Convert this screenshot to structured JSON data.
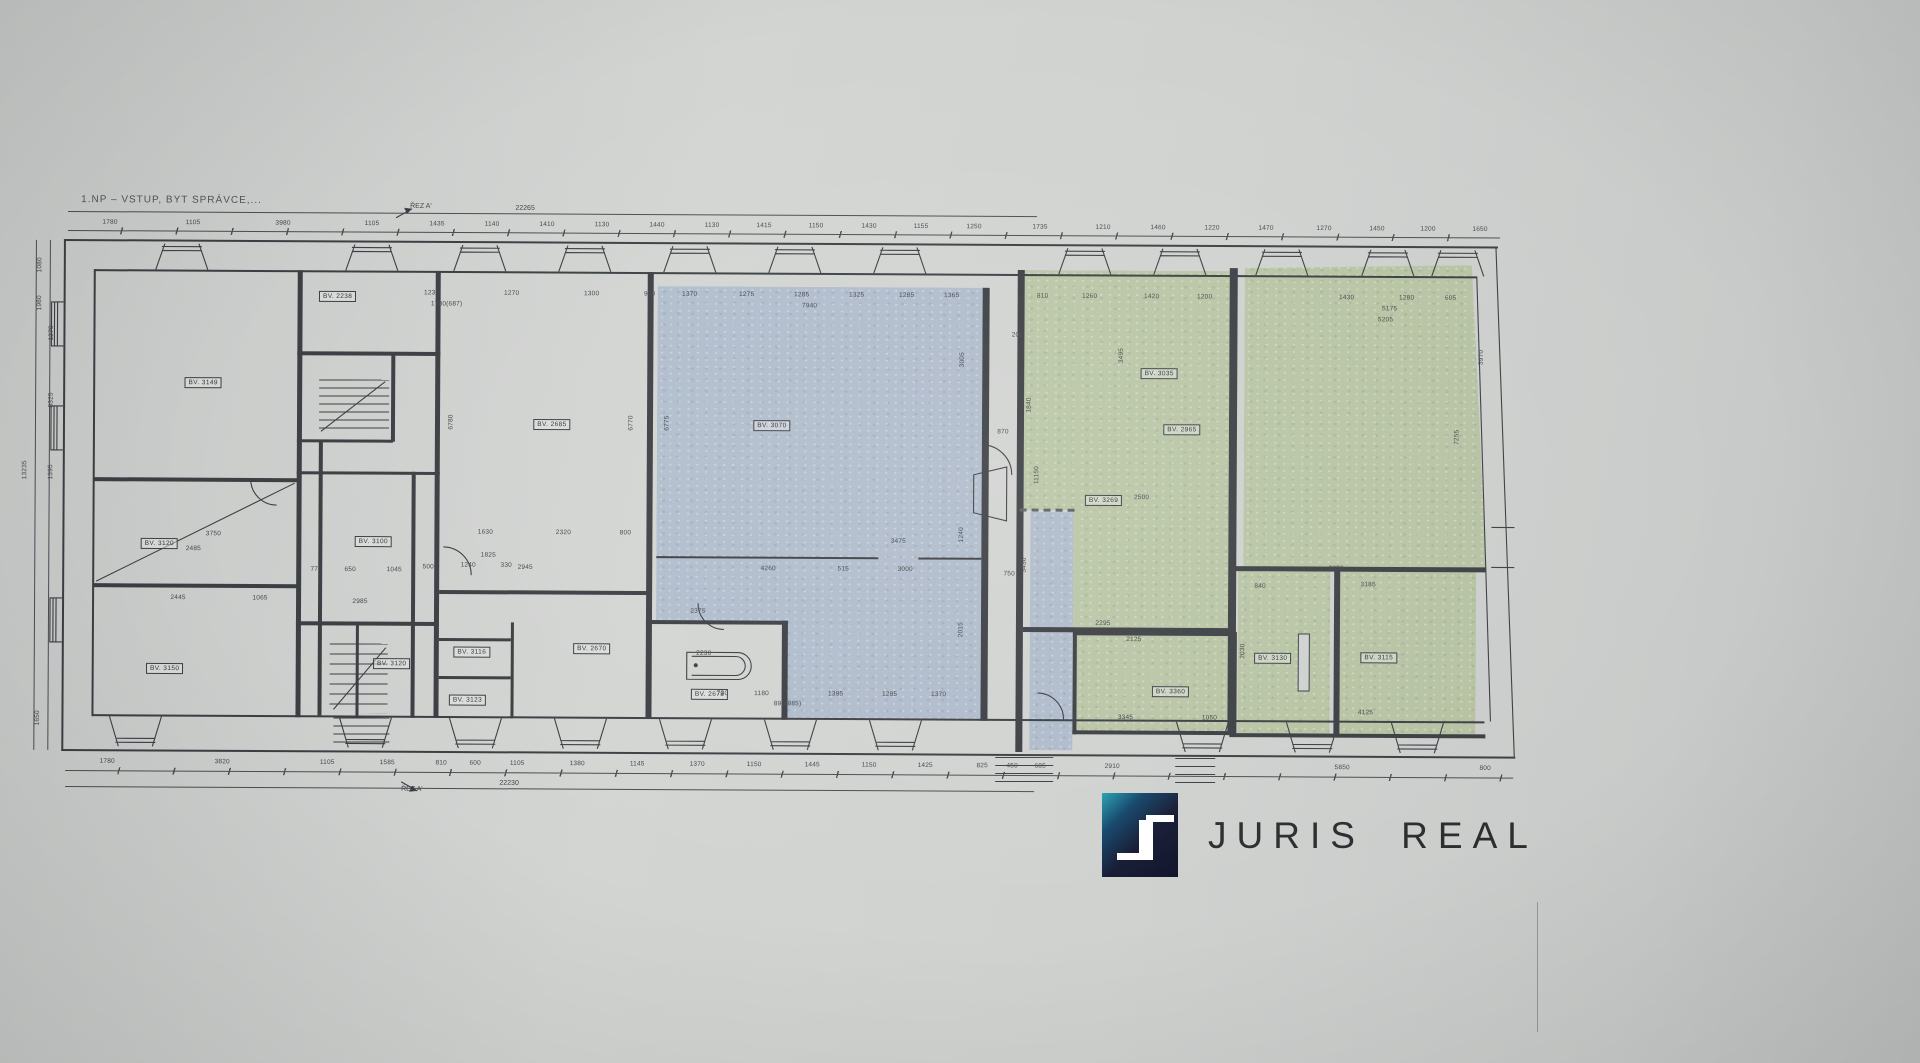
{
  "title": "1.NP – VSTUP, BYT SPRÁVCE,...",
  "section_mark_top": "ŘEZ A'",
  "section_mark_bottom": "ŘEZ A'",
  "overall_dim_top": "22265",
  "overall_dim_bottom": "22230",
  "logo": {
    "brand": "JURIS REAL"
  },
  "colors": {
    "paper": "#cfd1d0",
    "line": "#3b3e42",
    "dim_text": "#45484d",
    "blue_tint": "#b9c7da",
    "green_tint": "#c2cfa9",
    "logo_navy": "#161b34",
    "logo_teal": "#26a2b0",
    "logo_text": "#2c2d2f"
  },
  "rooms": [
    {
      "label": "BV. 3149",
      "x": 204,
      "y": 382
    },
    {
      "label": "BV. 2238",
      "x": 338,
      "y": 295
    },
    {
      "label": "BV. 3120",
      "x": 161,
      "y": 543
    },
    {
      "label": "BV. 3150",
      "x": 167,
      "y": 668
    },
    {
      "label": "BV. 2685",
      "x": 553,
      "y": 422
    },
    {
      "label": "BV. 3100",
      "x": 375,
      "y": 540
    },
    {
      "label": "BV. 3070",
      "x": 773,
      "y": 422
    },
    {
      "label": "BV. 2670",
      "x": 594,
      "y": 646
    },
    {
      "label": "BV. 2678",
      "x": 712,
      "y": 691
    },
    {
      "label": "BV. 3120",
      "x": 394,
      "y": 662
    },
    {
      "label": "BV. 3116",
      "x": 474,
      "y": 650
    },
    {
      "label": "BV. 3123",
      "x": 470,
      "y": 698
    },
    {
      "label": "BV. 3035",
      "x": 1160,
      "y": 368
    },
    {
      "label": "BV. 2965",
      "x": 1183,
      "y": 424
    },
    {
      "label": "BV. 3269",
      "x": 1105,
      "y": 495
    },
    {
      "label": "BV. 3360",
      "x": 1173,
      "y": 686
    },
    {
      "label": "BV. 3130",
      "x": 1275,
      "y": 652
    },
    {
      "label": "BV. 3115",
      "x": 1381,
      "y": 651
    }
  ],
  "dims_top": [
    {
      "t": "1780",
      "x": 110
    },
    {
      "t": "1105",
      "x": 193
    },
    {
      "t": "3980",
      "x": 283
    },
    {
      "t": "1105",
      "x": 372
    },
    {
      "t": "1435",
      "x": 437
    },
    {
      "t": "1140",
      "x": 492
    },
    {
      "t": "1410",
      "x": 547
    },
    {
      "t": "1130",
      "x": 602
    },
    {
      "t": "1440",
      "x": 657
    },
    {
      "t": "1130",
      "x": 712
    },
    {
      "t": "1415",
      "x": 764
    },
    {
      "t": "1150",
      "x": 816
    },
    {
      "t": "1430",
      "x": 869
    },
    {
      "t": "1155",
      "x": 921
    },
    {
      "t": "1250",
      "x": 974
    },
    {
      "t": "1735",
      "x": 1040
    },
    {
      "t": "1210",
      "x": 1103
    },
    {
      "t": "1460",
      "x": 1158
    },
    {
      "t": "1220",
      "x": 1212
    },
    {
      "t": "1470",
      "x": 1266
    },
    {
      "t": "1270",
      "x": 1324
    },
    {
      "t": "1450",
      "x": 1377
    },
    {
      "t": "1200",
      "x": 1428
    },
    {
      "t": "1650",
      "x": 1480
    }
  ],
  "dims_bottom": [
    {
      "t": "1780",
      "x": 110
    },
    {
      "t": "3820",
      "x": 225
    },
    {
      "t": "1105",
      "x": 330
    },
    {
      "t": "1585",
      "x": 390
    },
    {
      "t": "810",
      "x": 444
    },
    {
      "t": "600",
      "x": 478
    },
    {
      "t": "1105",
      "x": 520
    },
    {
      "t": "1380",
      "x": 580
    },
    {
      "t": "1145",
      "x": 640
    },
    {
      "t": "1370",
      "x": 700
    },
    {
      "t": "1150",
      "x": 757
    },
    {
      "t": "1445",
      "x": 815
    },
    {
      "t": "1150",
      "x": 872
    },
    {
      "t": "1425",
      "x": 928
    },
    {
      "t": "825",
      "x": 985
    },
    {
      "t": "450",
      "x": 1015
    },
    {
      "t": "685",
      "x": 1043
    },
    {
      "t": "2910",
      "x": 1115
    },
    {
      "t": "5850",
      "x": 1345
    },
    {
      "t": "800",
      "x": 1488
    }
  ],
  "dims_side": [
    {
      "t": "13235",
      "x": 26,
      "y": 470,
      "r": 1
    },
    {
      "t": "1080",
      "x": 40,
      "y": 265,
      "r": 1
    },
    {
      "t": "1980",
      "x": 40,
      "y": 303,
      "r": 1
    },
    {
      "t": "1270",
      "x": 52,
      "y": 333,
      "r": 1
    },
    {
      "t": "5325",
      "x": 52,
      "y": 400,
      "r": 1
    },
    {
      "t": "1395",
      "x": 52,
      "y": 472,
      "r": 1
    },
    {
      "t": "1650",
      "x": 40,
      "y": 718,
      "r": 1
    }
  ],
  "dims_inner": [
    {
      "t": "1230",
      "x": 432,
      "y": 291
    },
    {
      "t": "1270",
      "x": 512,
      "y": 291
    },
    {
      "t": "1300",
      "x": 592,
      "y": 291
    },
    {
      "t": "950",
      "x": 650,
      "y": 291
    },
    {
      "t": "1780(687)",
      "x": 447,
      "y": 302
    },
    {
      "t": "1370",
      "x": 690,
      "y": 291
    },
    {
      "t": "1275",
      "x": 747,
      "y": 291
    },
    {
      "t": "1285",
      "x": 802,
      "y": 291
    },
    {
      "t": "1325",
      "x": 857,
      "y": 291
    },
    {
      "t": "1285",
      "x": 907,
      "y": 291
    },
    {
      "t": "1365",
      "x": 952,
      "y": 291
    },
    {
      "t": "7940",
      "x": 810,
      "y": 302
    },
    {
      "t": "810",
      "x": 1043,
      "y": 291
    },
    {
      "t": "1260",
      "x": 1090,
      "y": 291
    },
    {
      "t": "1420",
      "x": 1152,
      "y": 291
    },
    {
      "t": "1200",
      "x": 1205,
      "y": 291
    },
    {
      "t": "1430",
      "x": 1347,
      "y": 291
    },
    {
      "t": "1280",
      "x": 1407,
      "y": 291
    },
    {
      "t": "605",
      "x": 1451,
      "y": 291
    },
    {
      "t": "5175",
      "x": 1390,
      "y": 302
    },
    {
      "t": "5205",
      "x": 1386,
      "y": 313
    },
    {
      "t": "6780",
      "x": 452,
      "y": 420,
      "r": 1
    },
    {
      "t": "6770",
      "x": 632,
      "y": 420,
      "r": 1
    },
    {
      "t": "6775",
      "x": 668,
      "y": 420,
      "r": 1
    },
    {
      "t": "3005",
      "x": 963,
      "y": 355,
      "r": 1
    },
    {
      "t": "1240",
      "x": 963,
      "y": 530,
      "r": 1
    },
    {
      "t": "2015",
      "x": 963,
      "y": 625,
      "r": 1
    },
    {
      "t": "3495",
      "x": 1122,
      "y": 350,
      "r": 1
    },
    {
      "t": "1840",
      "x": 1030,
      "y": 400,
      "r": 1
    },
    {
      "t": "11150",
      "x": 1038,
      "y": 470,
      "r": 1
    },
    {
      "t": "3430",
      "x": 1026,
      "y": 560,
      "r": 1
    },
    {
      "t": "3970",
      "x": 1482,
      "y": 350,
      "r": 1
    },
    {
      "t": "7255",
      "x": 1458,
      "y": 430,
      "r": 1
    },
    {
      "t": "2030",
      "x": 1245,
      "y": 645,
      "r": 1
    },
    {
      "t": "1630",
      "x": 487,
      "y": 530
    },
    {
      "t": "2320",
      "x": 565,
      "y": 530
    },
    {
      "t": "800",
      "x": 627,
      "y": 530
    },
    {
      "t": "1825",
      "x": 490,
      "y": 553
    },
    {
      "t": "2945",
      "x": 527,
      "y": 565
    },
    {
      "t": "3475",
      "x": 900,
      "y": 537
    },
    {
      "t": "4260",
      "x": 770,
      "y": 565
    },
    {
      "t": "515",
      "x": 845,
      "y": 565
    },
    {
      "t": "3000",
      "x": 907,
      "y": 565
    },
    {
      "t": "2375",
      "x": 700,
      "y": 608
    },
    {
      "t": "2230",
      "x": 706,
      "y": 650
    },
    {
      "t": "730",
      "x": 725,
      "y": 690
    },
    {
      "t": "1180",
      "x": 764,
      "y": 690
    },
    {
      "t": "1395",
      "x": 838,
      "y": 690
    },
    {
      "t": "1285",
      "x": 892,
      "y": 690
    },
    {
      "t": "1370",
      "x": 941,
      "y": 690
    },
    {
      "t": "890(885)",
      "x": 790,
      "y": 700
    },
    {
      "t": "770",
      "x": 318,
      "y": 568
    },
    {
      "t": "650",
      "x": 352,
      "y": 568
    },
    {
      "t": "1045",
      "x": 396,
      "y": 568
    },
    {
      "t": "2985",
      "x": 362,
      "y": 600
    },
    {
      "t": "500",
      "x": 430,
      "y": 565
    },
    {
      "t": "1240",
      "x": 470,
      "y": 563
    },
    {
      "t": "330",
      "x": 508,
      "y": 563
    },
    {
      "t": "2445",
      "x": 180,
      "y": 597
    },
    {
      "t": "1065",
      "x": 262,
      "y": 597
    },
    {
      "t": "2485",
      "x": 195,
      "y": 548
    },
    {
      "t": "3750",
      "x": 215,
      "y": 533
    },
    {
      "t": "2500",
      "x": 1143,
      "y": 492
    },
    {
      "t": "2295",
      "x": 1105,
      "y": 618
    },
    {
      "t": "2125",
      "x": 1136,
      "y": 634
    },
    {
      "t": "3345",
      "x": 1128,
      "y": 712
    },
    {
      "t": "1050",
      "x": 1212,
      "y": 712
    },
    {
      "t": "2650",
      "x": 1338,
      "y": 562
    },
    {
      "t": "4125",
      "x": 1368,
      "y": 706
    },
    {
      "t": "840",
      "x": 1262,
      "y": 580
    },
    {
      "t": "3185",
      "x": 1370,
      "y": 578
    },
    {
      "t": "200",
      "x": 1018,
      "y": 330
    },
    {
      "t": "870",
      "x": 1004,
      "y": 427
    },
    {
      "t": "750",
      "x": 1011,
      "y": 569
    }
  ]
}
